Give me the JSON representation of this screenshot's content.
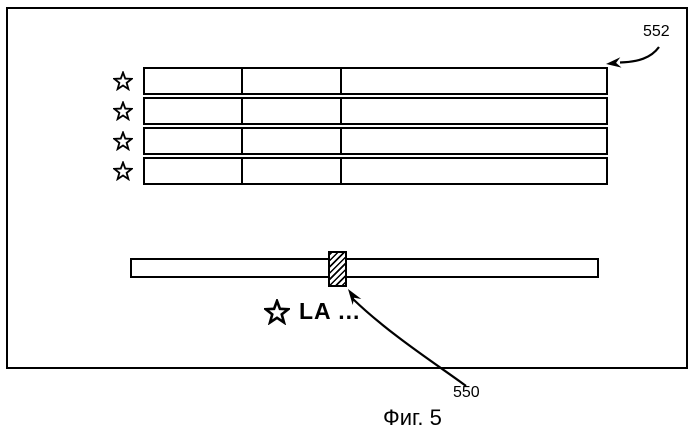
{
  "figure": {
    "caption": "Фиг. 5"
  },
  "colors": {
    "ink": "#000000",
    "paper": "#ffffff"
  },
  "media_table": {
    "ref_label": "552",
    "rows": 4,
    "columns": 3,
    "row_icon": "star-icon",
    "cells_text": ""
  },
  "slider": {
    "ref_label": "550",
    "caption_icon": "star-icon",
    "caption_text": "LA ...",
    "handle_style": "hatched"
  }
}
